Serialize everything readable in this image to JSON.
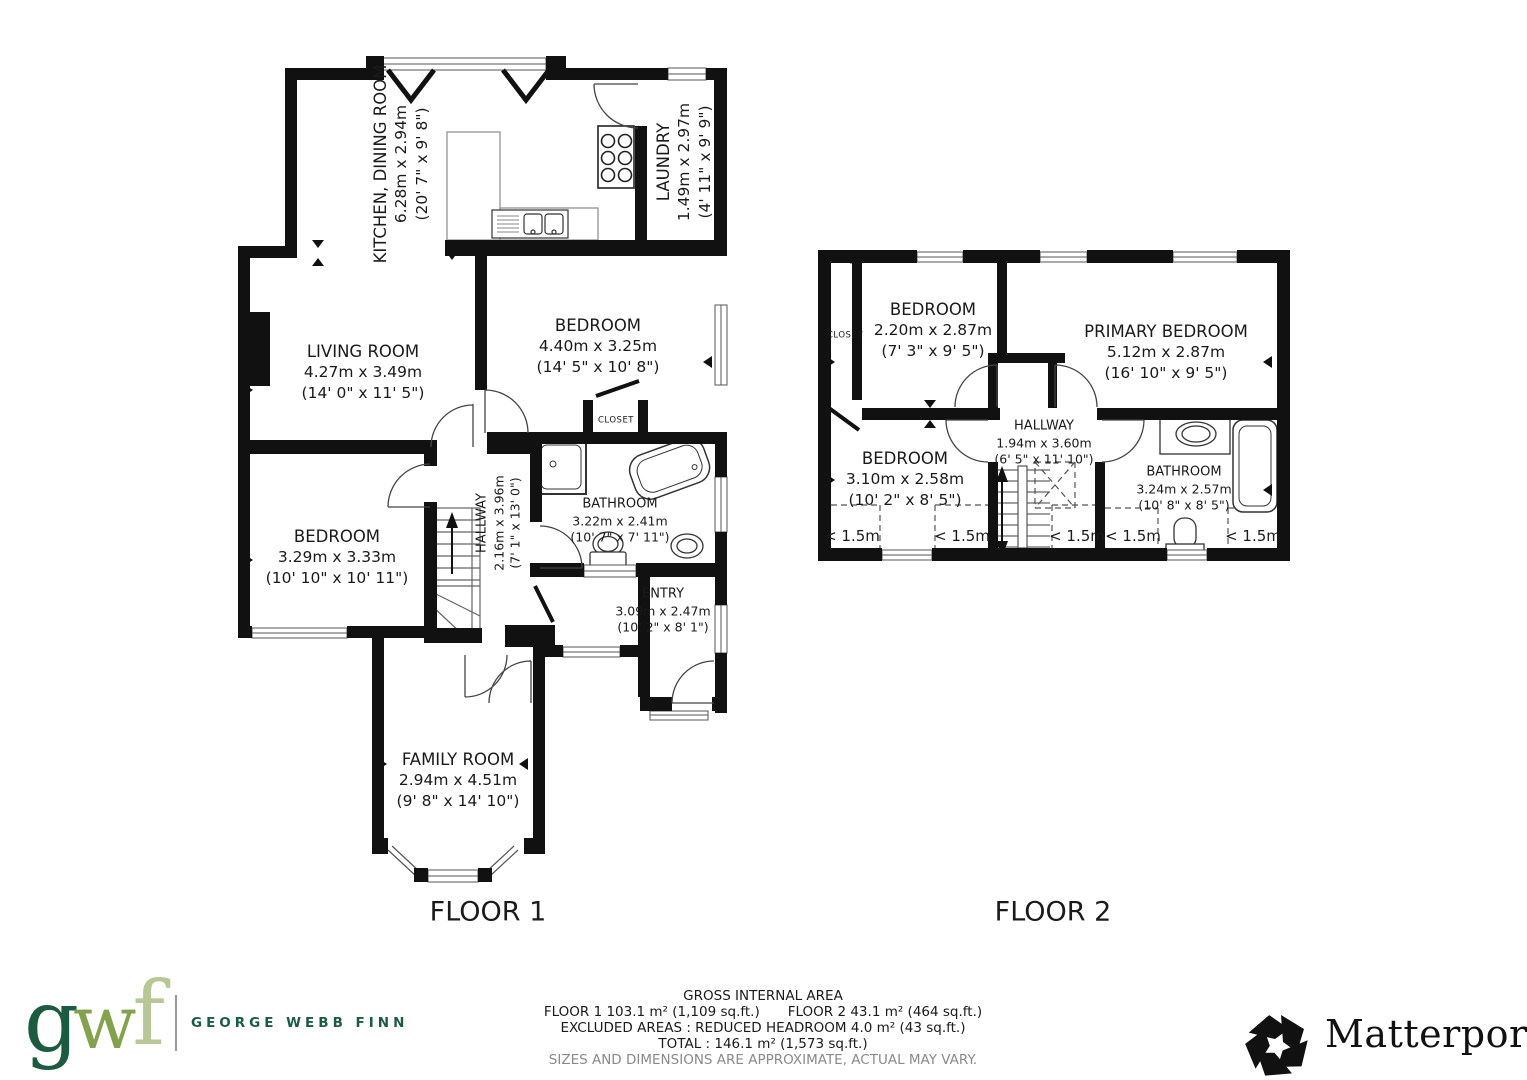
{
  "floor1": {
    "label": "FLOOR 1",
    "rooms": {
      "kitchen": {
        "name": "KITCHEN, DINING ROOM",
        "metric": "6.28m x 2.94m",
        "imperial": "(20' 7\" x 9' 8\")"
      },
      "laundry": {
        "name": "LAUNDRY",
        "metric": "1.49m x 2.97m",
        "imperial": "(4' 11\" x 9' 9\")"
      },
      "living": {
        "name": "LIVING ROOM",
        "metric": "4.27m x 3.49m",
        "imperial": "(14' 0\" x 11' 5\")"
      },
      "bedroom_top": {
        "name": "BEDROOM",
        "metric": "4.40m x 3.25m",
        "imperial": "(14' 5\" x 10' 8\")"
      },
      "closet": {
        "name": "CLOSET"
      },
      "bedroom_left": {
        "name": "BEDROOM",
        "metric": "3.29m x 3.33m",
        "imperial": "(10' 10\" x 10' 11\")"
      },
      "hallway": {
        "name": "HALLWAY",
        "metric": "2.16m x 3.96m",
        "imperial": "(7' 1\" x 13' 0\")"
      },
      "bathroom": {
        "name": "BATHROOM",
        "metric": "3.22m x 2.41m",
        "imperial": "(10' 7\" x 7' 11\")"
      },
      "entry": {
        "name": "ENTRY",
        "metric": "3.09m x 2.47m",
        "imperial": "(10' 2\" x 8' 1\")"
      },
      "family": {
        "name": "FAMILY ROOM",
        "metric": "2.94m x 4.51m",
        "imperial": "(9' 8\" x 14' 10\")"
      }
    }
  },
  "floor2": {
    "label": "FLOOR 2",
    "rooms": {
      "closet": {
        "name": "CLOSET"
      },
      "bedroom_top": {
        "name": "BEDROOM",
        "metric": "2.20m x 2.87m",
        "imperial": "(7' 3\" x 9' 5\")"
      },
      "primary": {
        "name": "PRIMARY BEDROOM",
        "metric": "5.12m x 2.87m",
        "imperial": "(16' 10\" x 9' 5\")"
      },
      "bedroom_bottom": {
        "name": "BEDROOM",
        "metric": "3.10m x 2.58m",
        "imperial": "(10' 2\" x 8' 5\")"
      },
      "hallway": {
        "name": "HALLWAY",
        "metric": "1.94m x 3.60m",
        "imperial": "(6' 5\" x 11' 10\")"
      },
      "bathroom": {
        "name": "BATHROOM",
        "metric": "3.24m x 2.57m",
        "imperial": "(10' 8\" x 8' 5\")"
      }
    },
    "headroom": [
      "< 1.5m",
      "< 1.5m",
      "< 1.5m",
      "< 1.5m",
      "< 1.5m"
    ]
  },
  "footer": {
    "area": {
      "title": "GROSS INTERNAL AREA",
      "floor1_area": "FLOOR 1 103.1 m² (1,109 sq.ft.)",
      "floor2_area": "FLOOR 2 43.1 m² (464 sq.ft.)",
      "excluded": "EXCLUDED AREAS :  REDUCED HEADROOM 4.0 m² (43 sq.ft.)",
      "total": "TOTAL :  146.1 m² (1,573 sq.ft.)",
      "disclaimer": "SIZES AND DIMENSIONS ARE APPROXIMATE, ACTUAL MAY VARY."
    },
    "gwf": {
      "letter_g": "g",
      "letter_w": "w",
      "letter_f": "f",
      "name": "GEORGE WEBB FINN",
      "color_g": "#1d5b40",
      "color_w": "#84a24e",
      "color_f": "#b7c795",
      "color_name": "#1d5b40"
    },
    "matterport": {
      "name": "Matterport",
      "registered": "®",
      "color": "#111111"
    }
  }
}
